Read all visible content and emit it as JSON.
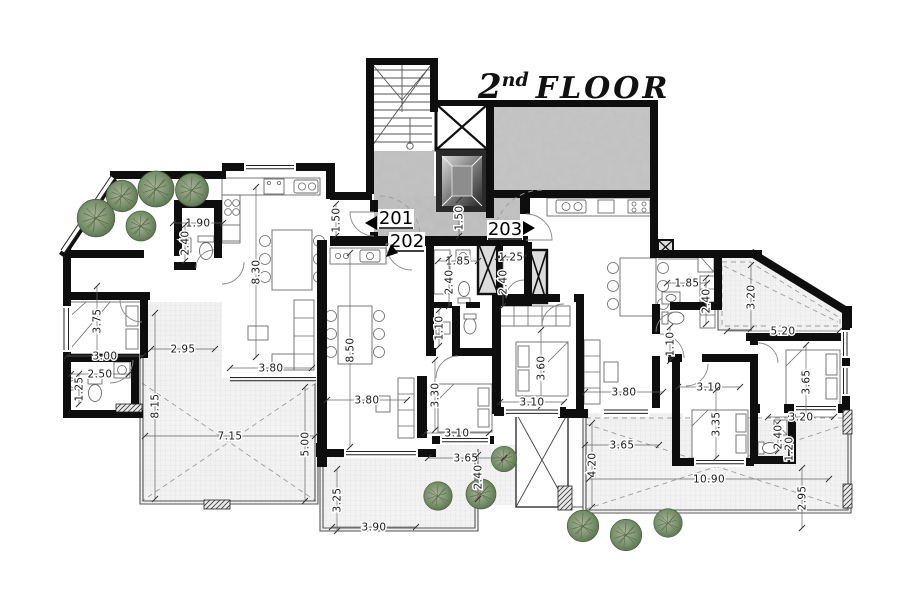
{
  "title": {
    "number": "2",
    "ordinal": "nd",
    "word": "FLOOR"
  },
  "units": [
    {
      "id": "201",
      "x": 396,
      "y": 224,
      "arrow": "left",
      "ax": 365,
      "ay": 223
    },
    {
      "id": "202",
      "x": 407,
      "y": 247,
      "arrow": "down-left",
      "ax": 386,
      "ay": 257
    },
    {
      "id": "203",
      "x": 505,
      "y": 235,
      "arrow": "right",
      "ax": 535,
      "ay": 228
    }
  ],
  "dimensions": [
    {
      "label": "1.90",
      "x": 198,
      "y": 223,
      "rot": 0,
      "len": 50
    },
    {
      "label": "2.40",
      "x": 185,
      "y": 243,
      "rot": 90,
      "len": 36
    },
    {
      "label": "8.30",
      "x": 256,
      "y": 272,
      "rot": 90,
      "len": 170
    },
    {
      "label": "3.75",
      "x": 97,
      "y": 321,
      "rot": 90,
      "len": 70
    },
    {
      "label": "3.00",
      "x": 105,
      "y": 356,
      "rot": 0,
      "len": 76
    },
    {
      "label": "2.95",
      "x": 183,
      "y": 349,
      "rot": 0,
      "len": 64
    },
    {
      "label": "2.50",
      "x": 100,
      "y": 374,
      "rot": 0,
      "len": 58
    },
    {
      "label": "1.25",
      "x": 79,
      "y": 389,
      "rot": 90,
      "len": 30
    },
    {
      "label": "8.15",
      "x": 155,
      "y": 406,
      "rot": 90,
      "len": 186
    },
    {
      "label": "7.15",
      "x": 230,
      "y": 436,
      "rot": 0,
      "len": 170
    },
    {
      "label": "5.00",
      "x": 305,
      "y": 444,
      "rot": 90,
      "len": 114
    },
    {
      "label": "3.80",
      "x": 271,
      "y": 368,
      "rot": 0,
      "len": 82
    },
    {
      "label": "8.50",
      "x": 350,
      "y": 350,
      "rot": 90,
      "len": 194
    },
    {
      "label": "1.50",
      "x": 336,
      "y": 220,
      "rot": 90,
      "len": 32
    },
    {
      "label": "1.50",
      "x": 459,
      "y": 218,
      "rot": 90,
      "len": 36
    },
    {
      "label": "1.85",
      "x": 458,
      "y": 261,
      "rot": 0,
      "len": 40
    },
    {
      "label": "2.40",
      "x": 449,
      "y": 282,
      "rot": 90,
      "len": 48
    },
    {
      "label": "1.25",
      "x": 511,
      "y": 257,
      "rot": 0,
      "len": 26
    },
    {
      "label": "2.40",
      "x": 503,
      "y": 282,
      "rot": 90,
      "len": 48
    },
    {
      "label": "1.10",
      "x": 439,
      "y": 328,
      "rot": 90,
      "len": 36
    },
    {
      "label": "3.80",
      "x": 367,
      "y": 400,
      "rot": 0,
      "len": 80
    },
    {
      "label": "3.30",
      "x": 435,
      "y": 395,
      "rot": 90,
      "len": 70
    },
    {
      "label": "3.10",
      "x": 457,
      "y": 433,
      "rot": 0,
      "len": 64
    },
    {
      "label": "3.60",
      "x": 541,
      "y": 368,
      "rot": 90,
      "len": 76
    },
    {
      "label": "3.10",
      "x": 532,
      "y": 402,
      "rot": 0,
      "len": 64
    },
    {
      "label": "3.65",
      "x": 466,
      "y": 458,
      "rot": 0,
      "len": 76
    },
    {
      "label": "2.40",
      "x": 478,
      "y": 477,
      "rot": 90,
      "len": 44
    },
    {
      "label": "3.25",
      "x": 337,
      "y": 500,
      "rot": 90,
      "len": 62
    },
    {
      "label": "3.90",
      "x": 374,
      "y": 527,
      "rot": 0,
      "len": 84
    },
    {
      "label": "1.85",
      "x": 687,
      "y": 283,
      "rot": 0,
      "len": 40
    },
    {
      "label": "2.40",
      "x": 706,
      "y": 301,
      "rot": 90,
      "len": 46
    },
    {
      "label": "3.20",
      "x": 751,
      "y": 297,
      "rot": 90,
      "len": 64
    },
    {
      "label": "5.20",
      "x": 783,
      "y": 331,
      "rot": 0,
      "len": 112
    },
    {
      "label": "3.80",
      "x": 624,
      "y": 392,
      "rot": 0,
      "len": 78
    },
    {
      "label": "1.10",
      "x": 670,
      "y": 344,
      "rot": 90,
      "len": 34
    },
    {
      "label": "3.10",
      "x": 709,
      "y": 387,
      "rot": 0,
      "len": 62
    },
    {
      "label": "3.35",
      "x": 716,
      "y": 424,
      "rot": 90,
      "len": 68
    },
    {
      "label": "3.65",
      "x": 806,
      "y": 382,
      "rot": 90,
      "len": 74
    },
    {
      "label": "3.20",
      "x": 801,
      "y": 417,
      "rot": 0,
      "len": 66
    },
    {
      "label": "3.65",
      "x": 622,
      "y": 445,
      "rot": 0,
      "len": 74
    },
    {
      "label": "4.20",
      "x": 592,
      "y": 465,
      "rot": 90,
      "len": 84
    },
    {
      "label": "10.90",
      "x": 709,
      "y": 479,
      "rot": 0,
      "len": 240
    },
    {
      "label": "2.95",
      "x": 802,
      "y": 498,
      "rot": 90,
      "len": 60
    },
    {
      "label": "2.40",
      "x": 778,
      "y": 437,
      "rot": 90,
      "len": 28
    },
    {
      "label": "1.20",
      "x": 789,
      "y": 449,
      "rot": 90,
      "len": 22
    }
  ],
  "colors": {
    "walls": "#0e0e0e",
    "corridor_floor": "#c3c3c3",
    "terrace_floor": "#f4f4f4",
    "vegetation": "#6f855f",
    "dimension_text": "#1a1a1a",
    "background": "#ffffff"
  }
}
